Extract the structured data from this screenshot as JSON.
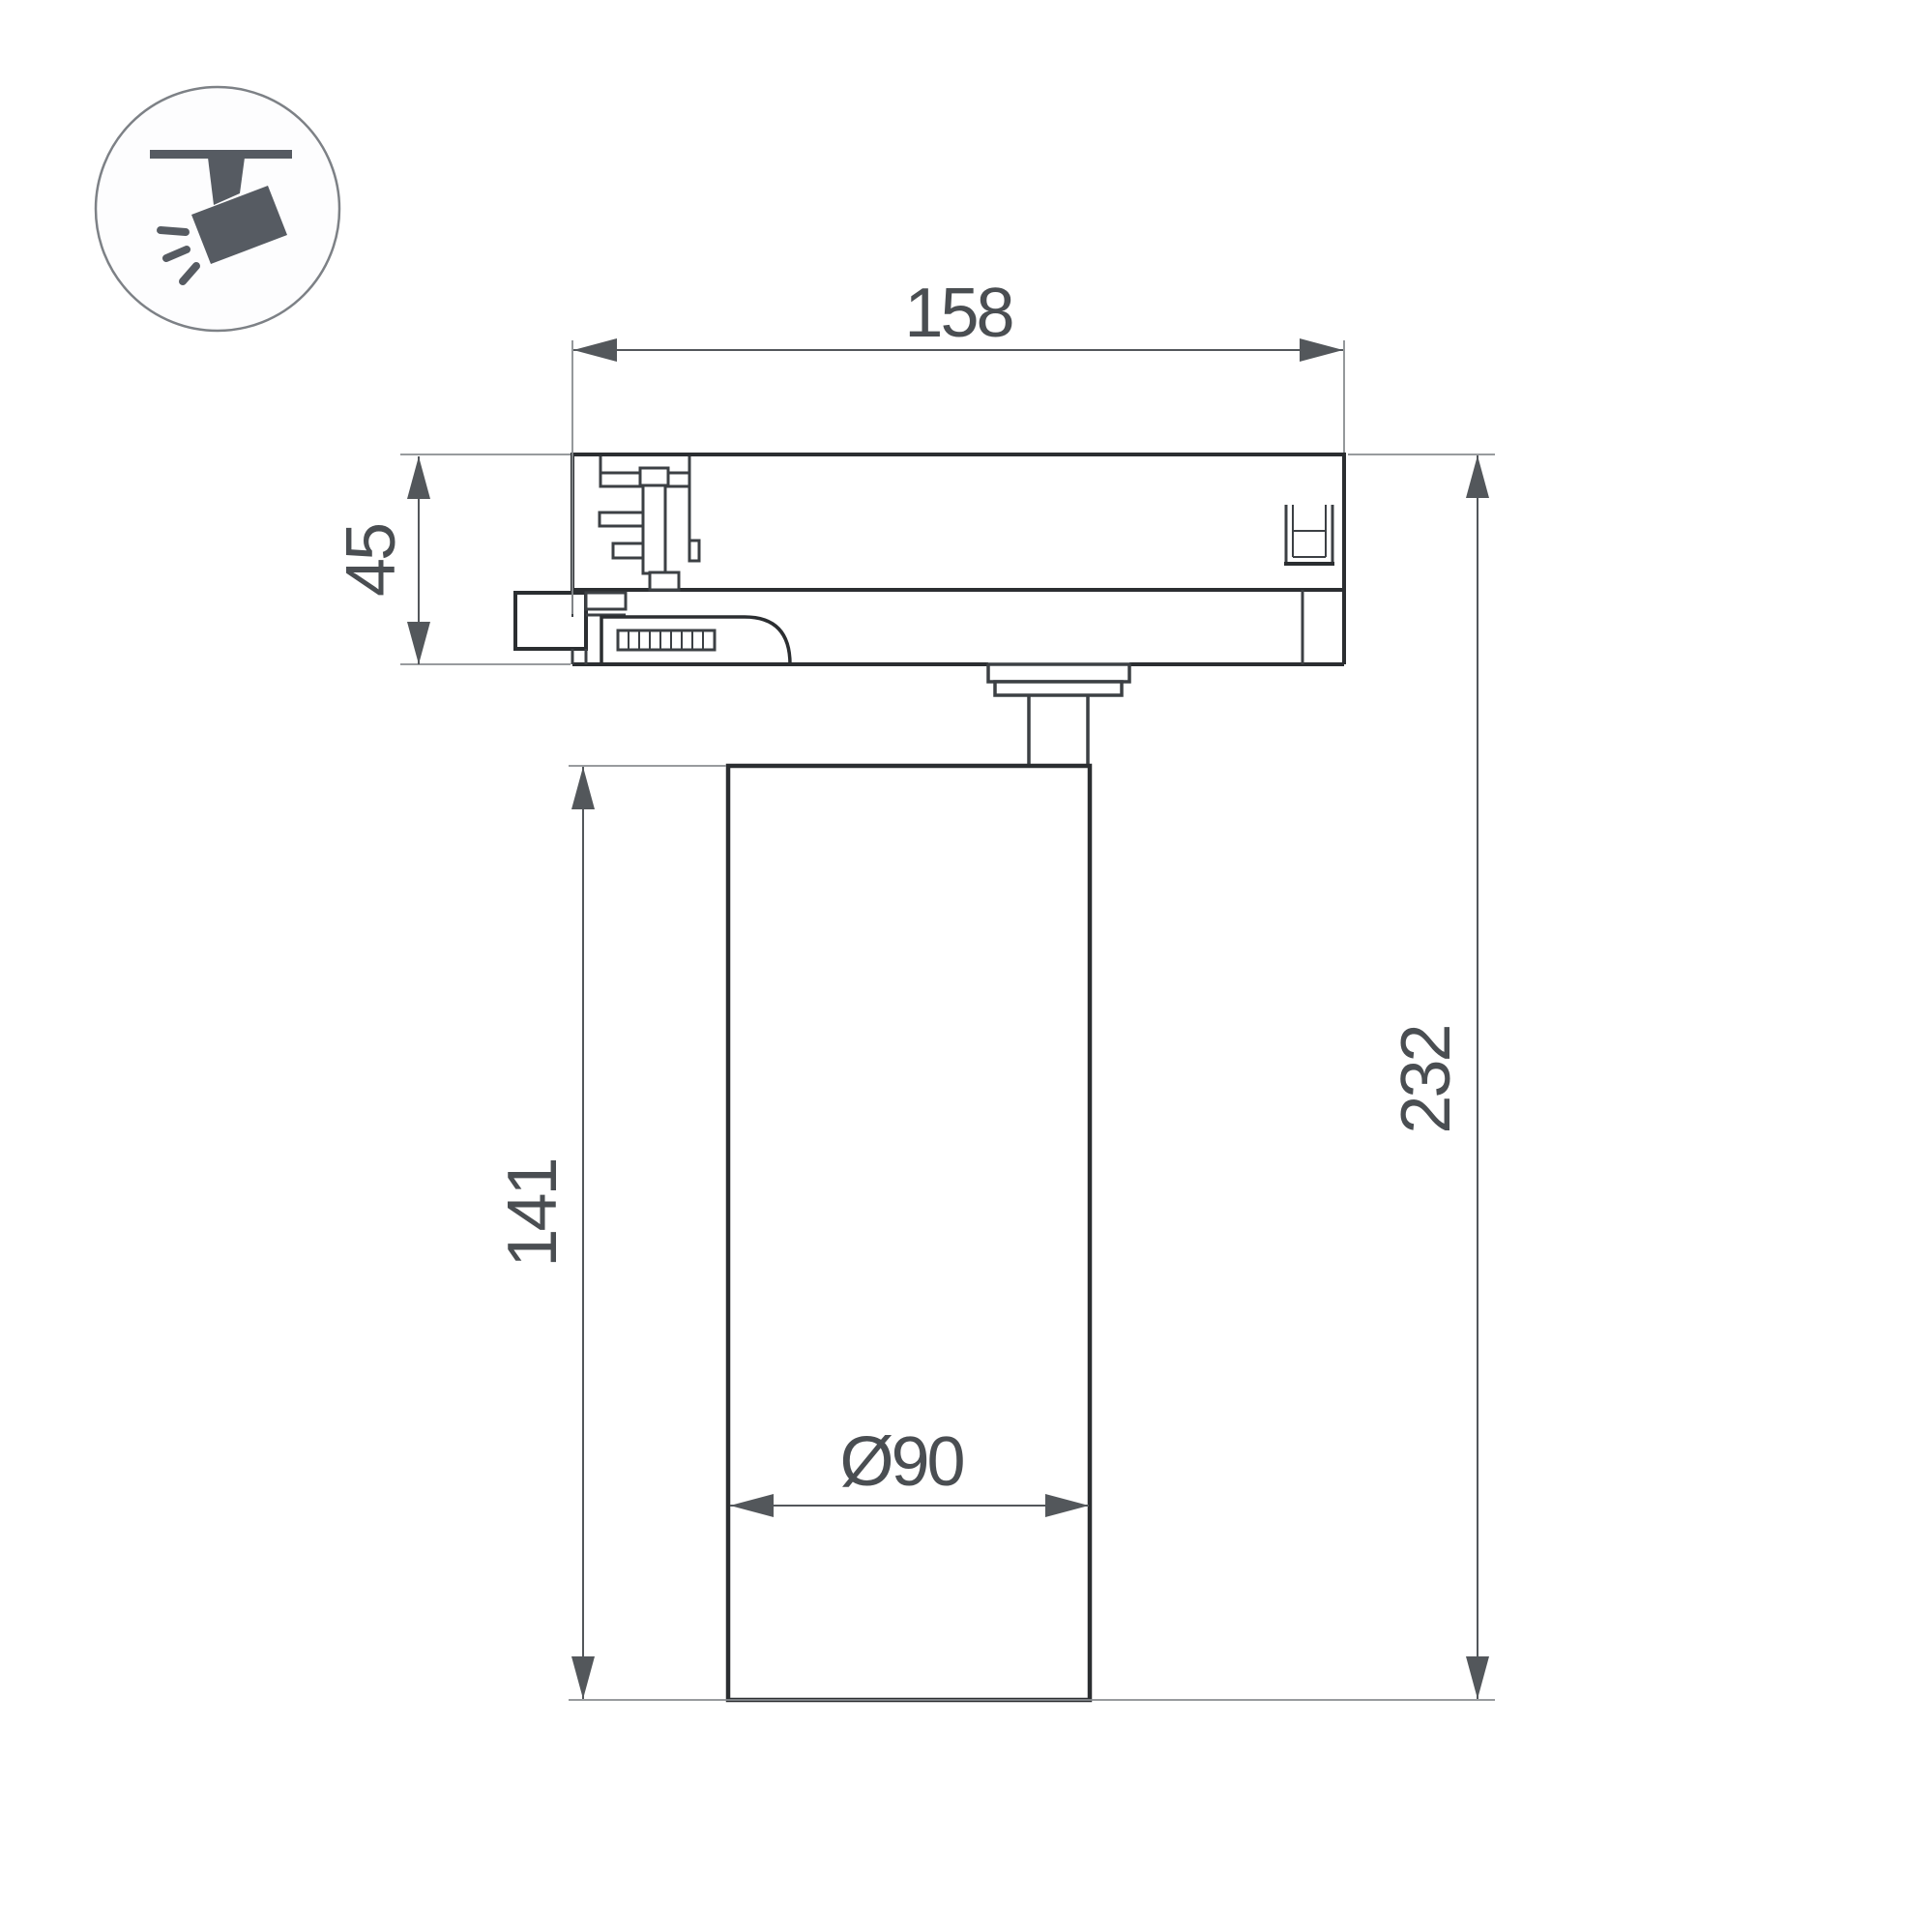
{
  "title": "Track spotlight dimension drawing",
  "icon": {
    "name": "track-spotlight-icon"
  },
  "dimensions": {
    "width_top": {
      "value": "158",
      "meaning": "track adapter length"
    },
    "adapter_height": {
      "value": "45",
      "meaning": "track adapter height"
    },
    "body_height": {
      "value": "141",
      "meaning": "lamp body height"
    },
    "total_height": {
      "value": "232",
      "meaning": "overall height"
    },
    "body_diameter": {
      "value": "Ø90",
      "meaning": "lamp body diameter"
    }
  },
  "colors": {
    "background": "#ffffff",
    "part_line": "#2b2e31",
    "part_line_light": "#3c4044",
    "dim_line": "#53575b",
    "ext_line": "#898d90",
    "text": "#4a4e52",
    "icon_glyph": "#565b62",
    "icon_circle": "#7d8186"
  }
}
